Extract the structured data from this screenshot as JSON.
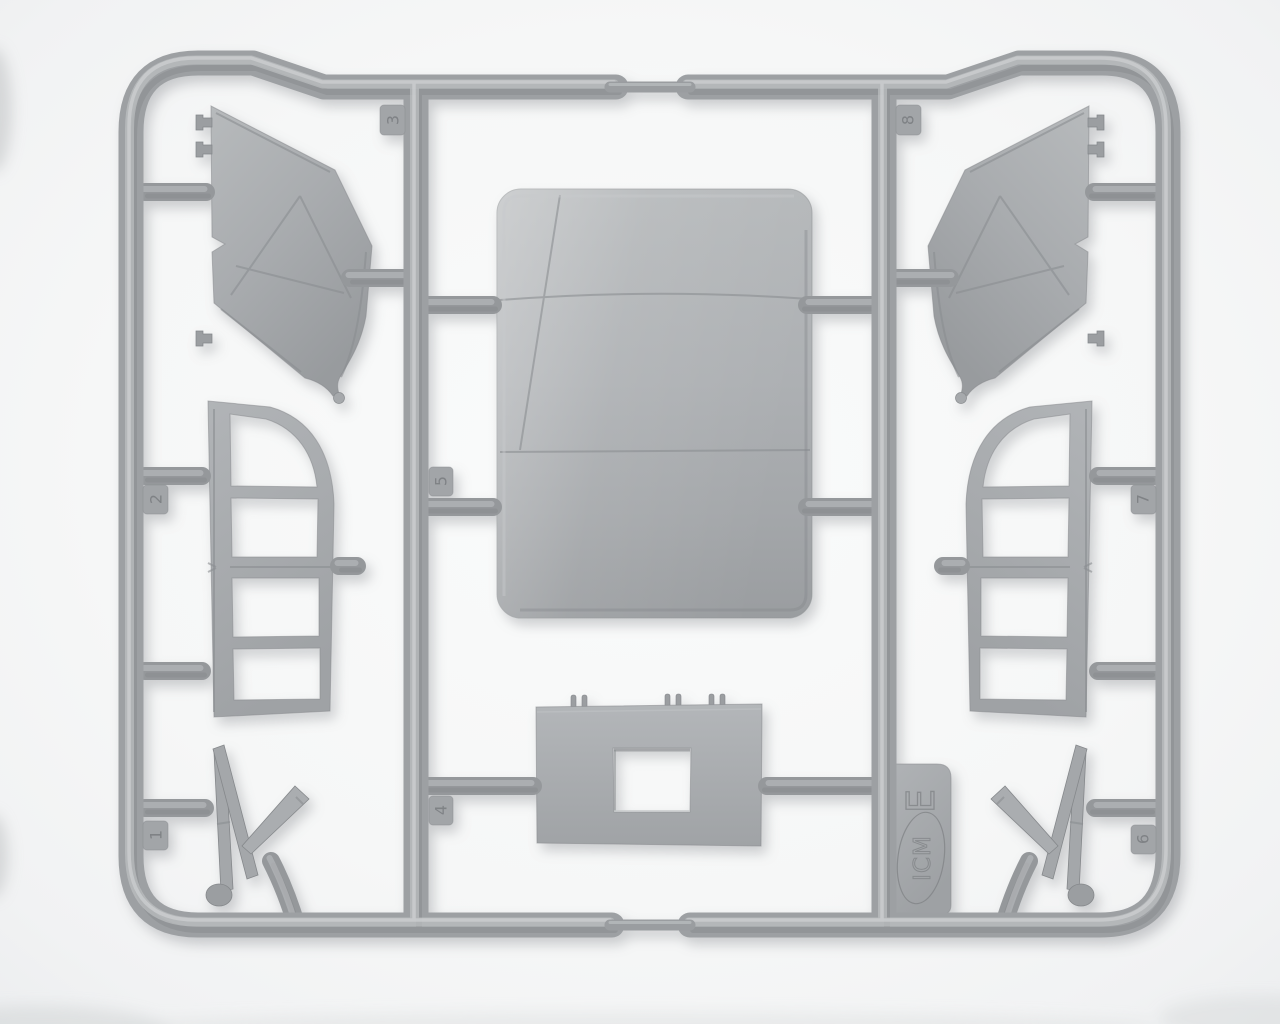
{
  "photo": {
    "subject": "Injection-molded plastic model sprue with parts on white background",
    "plastic_color": "#a7aaad",
    "background_color": "#f6f7f8"
  },
  "sprue": {
    "brand_logo_text": "ICM",
    "sprue_letter": "E",
    "gate_numbers": [
      "1",
      "2",
      "3",
      "4",
      "5",
      "6",
      "7",
      "8"
    ]
  }
}
